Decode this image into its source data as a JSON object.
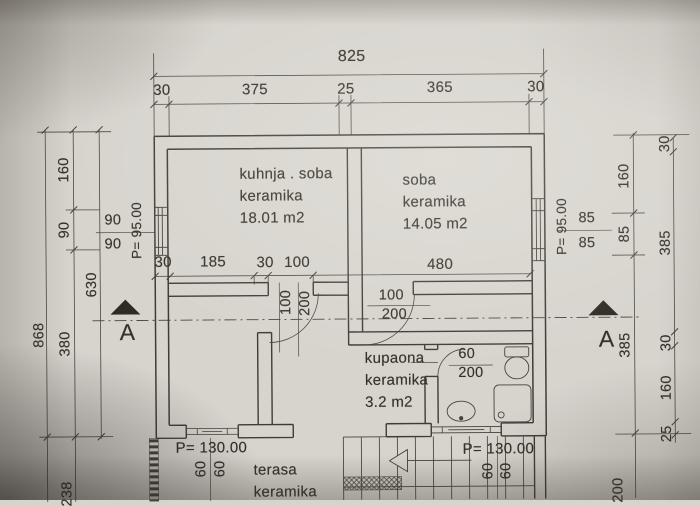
{
  "colors": {
    "paper": "#d7d4ce",
    "line": "#44403a",
    "text": "#35312b"
  },
  "rooms": {
    "room1": {
      "line1": "kuhnja . soba",
      "line2": "keramika",
      "line3": "18.01 m2"
    },
    "room2": {
      "line1": "soba",
      "line2": "keramika",
      "line3": "14.05 m2"
    },
    "bathroom": {
      "line1": "kupaona",
      "line2": "keramika",
      "line3": "3.2 m2"
    },
    "terrace": {
      "line1": "terasa",
      "line2": "keramika"
    }
  },
  "levels": {
    "main_left": "P= 95.00",
    "main_right": "P= 95.00",
    "terrace_left": "P= 130.00",
    "terrace_right": "P= 130.00"
  },
  "section": {
    "left": "A",
    "right": "A"
  },
  "dims": {
    "top_total": "825",
    "top": [
      "30",
      "375",
      "25",
      "365",
      "30"
    ],
    "mid": [
      "30",
      "185",
      "30",
      "100",
      "480"
    ],
    "left_total": "868",
    "left_chain": [
      "160",
      "90",
      "380",
      "238"
    ],
    "left_sub": "630",
    "left_parapet": [
      "90",
      "90"
    ],
    "right_parapet": [
      "85",
      "85"
    ],
    "right_chain": [
      "160",
      "85",
      "385",
      "200"
    ],
    "right_outer": [
      "30",
      "385",
      "30",
      "160",
      "25"
    ],
    "door_left": [
      "100",
      "200"
    ],
    "door_soba": [
      "100",
      "200"
    ],
    "door_bath": [
      "60",
      "200"
    ],
    "sill_left": [
      "60",
      "60"
    ],
    "sill_right": [
      "60",
      "60"
    ]
  }
}
